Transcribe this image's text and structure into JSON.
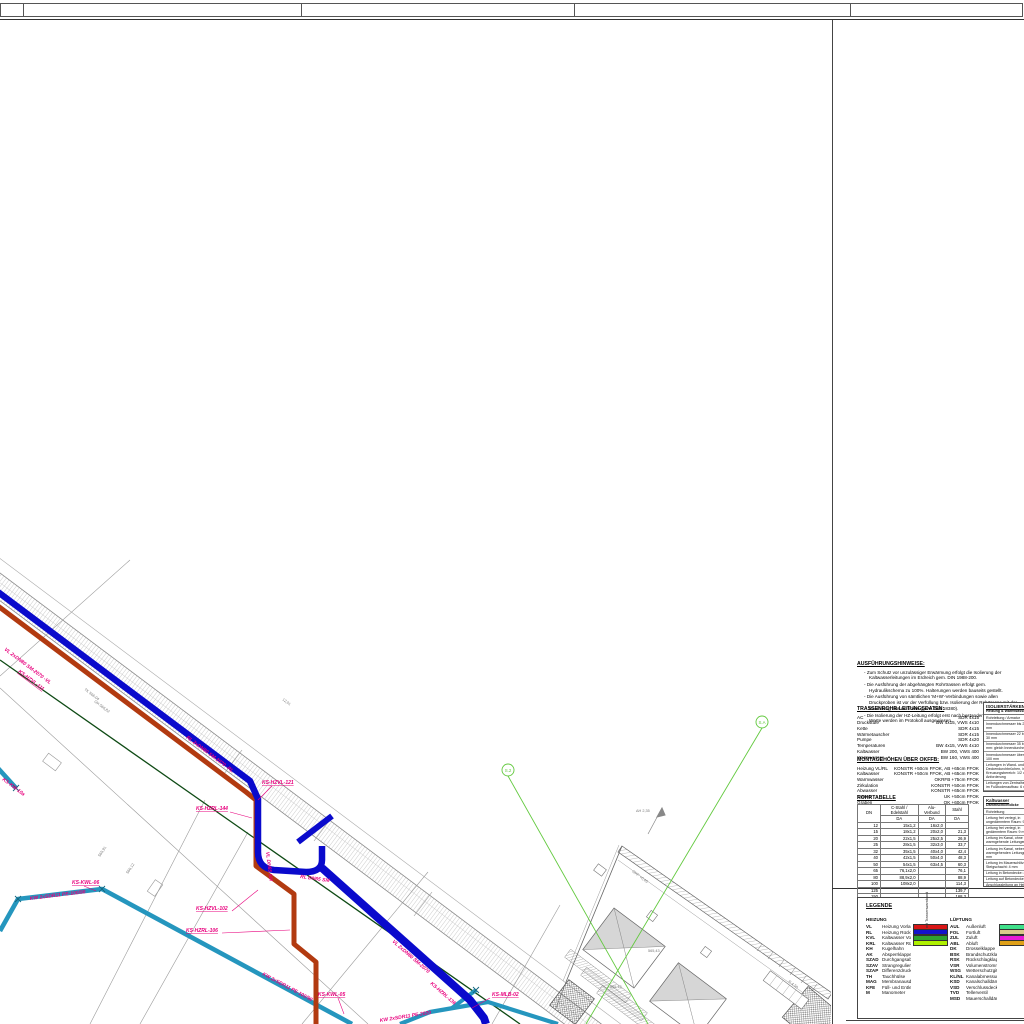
{
  "sheet": {
    "top_cells": [
      "",
      "",
      "",
      "",
      ""
    ]
  },
  "notes": {
    "title": "AUSFÜHRUNGSHINWEISE:",
    "items": [
      "Zum Schutz vor unzulässiger Erwärmung erfolgt die Isolierung der Kaltwasserleitungen im Erdreich gem. DIN 1988-200.",
      "Die Ausführung der abgehängten Rohrtrassen erfolgt gem. Hydraulikschema zu 100%. Halterungen werden bauseits gestellt.",
      "Die Ausführung von sämtlichen 'M+W'-Verbindungen sowie allen Druckproben ist vor der Verfüllung bzw. Isolierung der Rohrtrasse mit der Bauleitung abzustimmen (gem. DIN 18380).",
      "Die Isolierung der HZ-Leitung erfolgt erst nach bestandener Druckprobe; Werte werden im Protokoll ausgewiesen."
    ]
  },
  "trassendaten": {
    "title": "TRASSENROHR-LEITUNGSDATEN:",
    "rows": [
      [
        "AC",
        "SDR 4x15"
      ],
      [
        "Druckstufe",
        "BW 4x15, VWS 4x10"
      ],
      [
        "Kette",
        "SDR 4x15"
      ],
      [
        "Wärmetauscher",
        "SDR 4x15"
      ],
      [
        "Pumpe",
        "SDR 4x20"
      ],
      [
        "Temperaturen",
        "BW 4x15, VWS 4x10"
      ],
      [
        "Kaltwasser",
        "BW 200, VWS 400"
      ],
      [
        "Warmwasser",
        "BW 160, VWS 400"
      ]
    ]
  },
  "montage": {
    "title": "MONTAGEHÖHEN ÜBER OKFFB:",
    "rows": [
      [
        "Heizung VL/RL",
        "KONSTR +50cm FFOK, AB +65cm FFOK"
      ],
      [
        "Kaltwasser",
        "KONSTR +50cm FFOK, AB +65cm FFOK"
      ],
      [
        "Warmwasser",
        "OKRFB +75cm FFOK"
      ],
      [
        "Zirkulation",
        "KONSTR +50cm FFOK"
      ],
      [
        "Abwasser",
        "KONSTR +65cm FFOK"
      ],
      [
        "Trasse",
        "UK +50cm FFOK"
      ],
      [
        "Graben",
        "OK +60cm FFOK"
      ]
    ]
  },
  "rohrtabelle": {
    "title": "ROHRTABELLE",
    "col_groups": [
      "DN",
      "C-Stahl / Edelstahl",
      "Alu-Verbund",
      "Stahl"
    ],
    "sub_headers": [
      "DA",
      "DA",
      "DA"
    ],
    "rows": [
      [
        "12",
        "15x1,2",
        "16x2,0",
        ""
      ],
      [
        "15",
        "18x1,2",
        "20x2,0",
        "21,3"
      ],
      [
        "20",
        "22x1,5",
        "25x2,5",
        "26,9"
      ],
      [
        "25",
        "28x1,5",
        "32x3,0",
        "33,7"
      ],
      [
        "32",
        "35x1,5",
        "40x4,0",
        "42,4"
      ],
      [
        "40",
        "42x1,5",
        "50x4,0",
        "48,3"
      ],
      [
        "50",
        "54x1,5",
        "63x4,5",
        "60,3"
      ],
      [
        "65",
        "76,1x2,0",
        "",
        "76,1"
      ],
      [
        "80",
        "88,9x2,0",
        "",
        "88,9"
      ],
      [
        "100",
        "108x2,0",
        "",
        "114,3"
      ],
      [
        "125",
        "",
        "",
        "139,7"
      ],
      [
        "150",
        "",
        "",
        "168,3"
      ]
    ]
  },
  "iso_boxes": [
    {
      "title": "ISOLIERSTÄRKEN",
      "subtitle": "Heizung & Warmwasser",
      "rows": [
        "Rohrleitung / Armatur",
        "Innendurchmesser bis 22 mm: 20 mm",
        "Innendurchmesser 22 bis 35 mm: 30 mm",
        "Innendurchmesser 35 bis 100 mm: gleich Innendurchmesser",
        "Innendurchmesser über 100 mm: 100 mm",
        "Leitungen in Wand- und Deckendurchbrüchen, im Kreuzungsbereich: 1/2 der Anforderung",
        "Leitungen von Zentralheizungen im Fußbodenaufbau: 6 mm",
        "Stichleitungen bis 8 m Länge: 1/2 der Anforderung",
        "lt. EnEV Anlage 5"
      ]
    },
    {
      "title": "Kaltwasser",
      "subtitle": "Dämmschichtdicke",
      "rows": [
        "Rohrleitung",
        "Leitung frei verlegt, in ungedämmtem Raum: 9 mm",
        "Leitung frei verlegt, in gedämmtem Raum: 9 mm",
        "Leitung im Kanal, ohne warmgehende Leitungen: 4 mm",
        "Leitung im Kanal, neben warmgehenden Leitungen: 13 mm",
        "Leitung im Mauerschlitz / Steigschacht: 4 mm",
        "Leitung in Betondecke: 4 mm",
        "Leitung auf Betondecke: 4 mm",
        "Anschlussleitung an Heizkörper: 4 mm",
        "lt. DIN 1988-200"
      ]
    }
  ],
  "legend": {
    "title": "LEGENDE",
    "heizung_title": "HEIZUNG",
    "lueftung_title": "LÜFTUNG",
    "note_vertical": "mit Trassenwarnband",
    "heizung": [
      {
        "abbr": "VL",
        "name": "Heizung Vorlauf",
        "color": "#d81616"
      },
      {
        "abbr": "RL",
        "name": "Heizung Rücklauf",
        "color": "#1414cc"
      },
      {
        "abbr": "KVL",
        "name": "Kaltwasser Vorlauf",
        "color": "#2fa32f"
      },
      {
        "abbr": "KRL",
        "name": "Kaltwasser Rücklauf",
        "color": "#aef000"
      },
      {
        "abbr": "KH",
        "name": "Kugelhahn",
        "color": null
      },
      {
        "abbr": "AK",
        "name": "Absperrklappe",
        "color": null
      },
      {
        "abbr": "SZAD",
        "name": "Durchgangsabsperrventil",
        "color": null
      },
      {
        "abbr": "SZAV",
        "name": "Strangregulierventil",
        "color": null
      },
      {
        "abbr": "SZAP",
        "name": "Differenzdruckregler",
        "color": null
      },
      {
        "abbr": "TH",
        "name": "Tauchhülse",
        "color": null
      },
      {
        "abbr": "MAG",
        "name": "Membranausdehnungsgefäß",
        "color": null
      },
      {
        "abbr": "KFE",
        "name": "Füll- und Entleerungshahn",
        "color": null
      },
      {
        "abbr": "M",
        "name": "Manometer",
        "color": null
      }
    ],
    "lueftung": [
      {
        "abbr": "AUL",
        "name": "Außenluft",
        "color": "#3fe08a"
      },
      {
        "abbr": "FOL",
        "name": "Fortluft",
        "color": "#dbc98a"
      },
      {
        "abbr": "ZUL",
        "name": "Zuluft",
        "color": "#e81ad6"
      },
      {
        "abbr": "ABL",
        "name": "Abluft",
        "color": "#dfa018"
      },
      {
        "abbr": "DK",
        "name": "Drosselklappe",
        "color": null
      },
      {
        "abbr": "BSK",
        "name": "Brandschutzklappe",
        "color": null
      },
      {
        "abbr": "RSK",
        "name": "Rückschlagklappe",
        "color": null
      },
      {
        "abbr": "VSR",
        "name": "Volumenstromregler",
        "color": null
      },
      {
        "abbr": "WSG",
        "name": "Wetterschutzgitter",
        "color": null
      },
      {
        "abbr": "KL/NL",
        "name": "Kanalabmessungen lt. DIN",
        "color": null
      },
      {
        "abbr": "KSD",
        "name": "Kanalschalldämpfer",
        "color": null
      },
      {
        "abbr": "VSD",
        "name": "Verschlussdeckel",
        "color": null
      },
      {
        "abbr": "TVD",
        "name": "Tellerventil",
        "color": null
      },
      {
        "abbr": "MSD",
        "name": "Mauerschalldämpfer",
        "color": null
      }
    ]
  },
  "drawing": {
    "colors": {
      "vl_red": "#b23a10",
      "rl_blue": "#0a0acc",
      "kw_teal": "#2596be",
      "boundary_green": "#0e4a14",
      "section_green": "#62c93e",
      "label_magenta": "#e8007d",
      "survey_gray": "#9a9a9a",
      "band_gray": "#8a8a8a"
    },
    "sections": [
      "S.2",
      "S.A"
    ],
    "pipe_labels": [
      "VL 2xDN80 SM-2070 -VL",
      "KS-HZVL-111",
      "RL 2xDN80 SM-2070 -RL",
      "KS-HZVL-121",
      "KS-HZRL-144",
      "VL DN65 SM",
      "RL DN65 SM",
      "KS-HZVL-102",
      "KS-HZRL-106",
      "VL 2xDN80 SM-2070",
      "KS-HZRL-136",
      "KS-MLB-02",
      "KS-KWL-06",
      "KW 2xSDR11 PE-100/90",
      "KS-KW-10a",
      "KW 2xSDR11 PE-100/90",
      "KS-KWL-05",
      "KW 2xSDR11 PE-2020"
    ],
    "gray_labels": [
      "TK 566,04",
      "OK 566,82",
      "565,91",
      "566,12",
      "12,01",
      "OKF +0,45",
      "565,43",
      "565,12",
      "R 4,50",
      "ΔH 2,35"
    ]
  }
}
